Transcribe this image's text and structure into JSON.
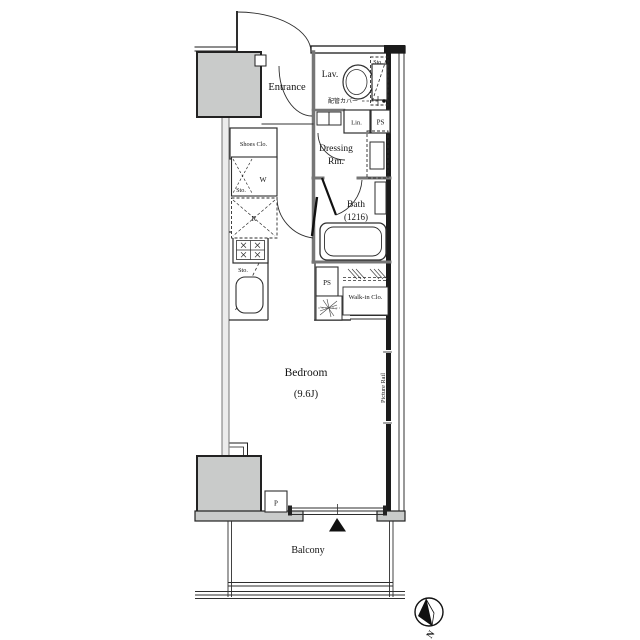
{
  "plan": {
    "rooms": {
      "entrance": {
        "label": "Entrance"
      },
      "lavatory": {
        "label": "Lav."
      },
      "dressing_room": {
        "line1": "Dressing",
        "line2": "Rm."
      },
      "bath": {
        "label": "Bath",
        "size": "(1216)"
      },
      "bedroom": {
        "label": "Bedroom",
        "size": "(9.6J)"
      },
      "walk_in_closet": {
        "label": "Walk-in Clo."
      },
      "balcony": {
        "label": "Balcony"
      }
    },
    "labels": {
      "shoes_closet": "Shoes Clo.",
      "storage_toilet": "Sto.",
      "pipe_cover": "配管カバー",
      "linen": "Lin.",
      "pipe_space_upper": "PS",
      "washer": "W",
      "storage_washer": "Sto.",
      "refrigerator": "R",
      "storage_kitchen": "Sto.",
      "pipe_space_lower": "PS",
      "picture_rail": "Picture Rail",
      "pipe_shaft": "P",
      "compass_north": "N"
    },
    "colors": {
      "outer_wall": "#1b1b1b",
      "partition": "#767676",
      "column_fill": "#c9cbca",
      "line": "#2e2e2e"
    }
  }
}
